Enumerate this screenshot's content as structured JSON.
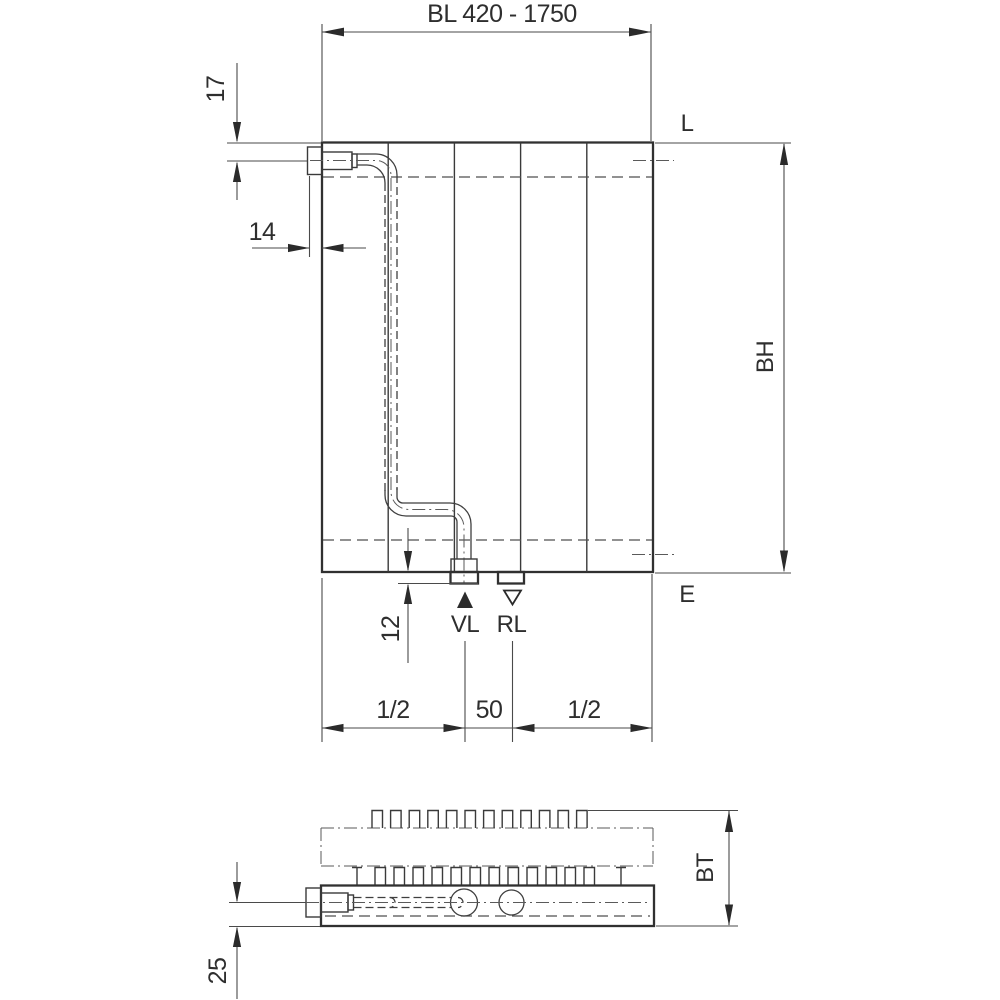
{
  "drawing": {
    "top_dimension": "BL 420 - 1750",
    "dim_17": "17",
    "dim_14": "14",
    "label_top_right": "L",
    "label_bottom_right": "E",
    "dim_height": "BH",
    "dim_12": "12",
    "supply_label": "VL",
    "return_label": "RL",
    "dim_half_left": "1/2",
    "dim_50": "50",
    "dim_half_right": "1/2",
    "dim_depth": "BT",
    "dim_25": "25",
    "colors": {
      "line": "#303030",
      "dimension_line": "#4a4a4a",
      "background": "#ffffff"
    }
  }
}
